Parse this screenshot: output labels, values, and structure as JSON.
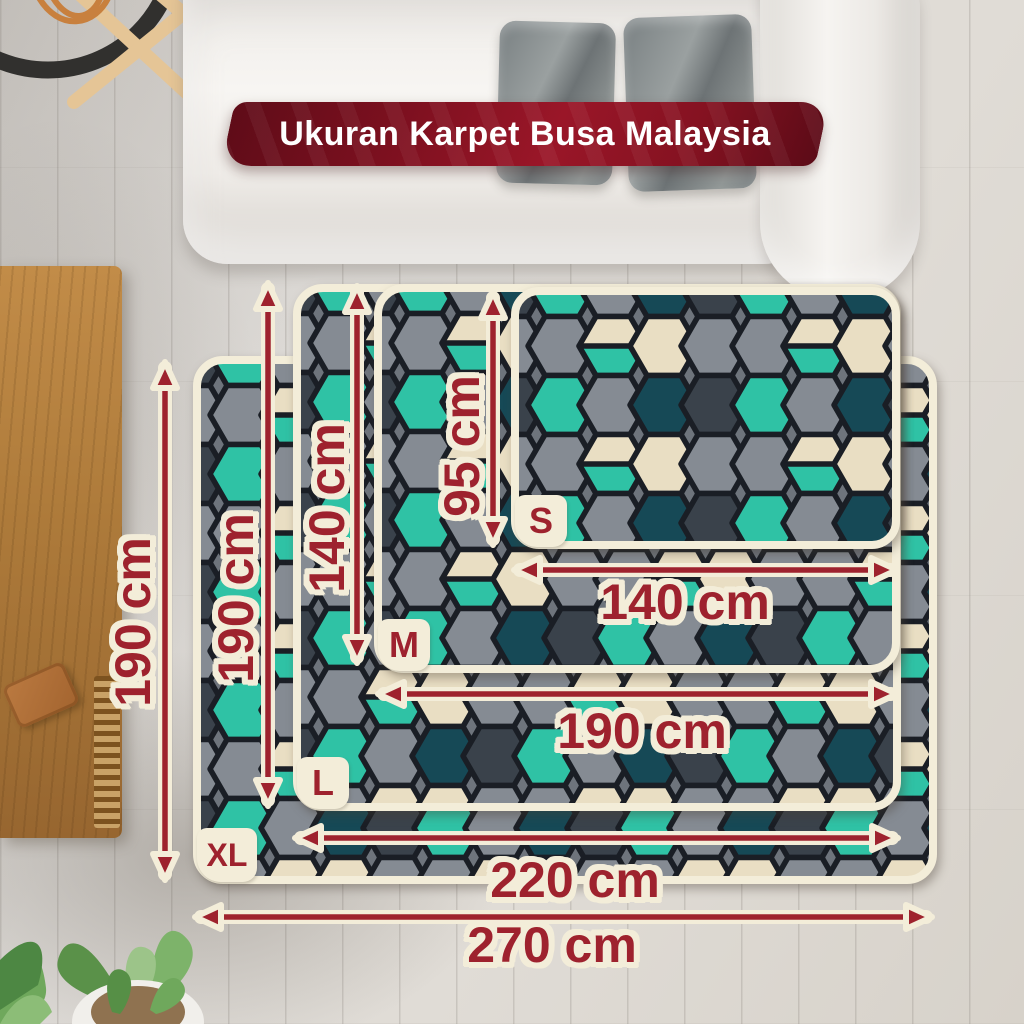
{
  "banner": {
    "title": "Ukuran Karpet Busa Malaysia"
  },
  "sizes": [
    {
      "code": "S",
      "width_cm": 140,
      "height_cm": 95,
      "width_label": "140 cm",
      "height_label": "95 cm"
    },
    {
      "code": "M",
      "width_cm": 190,
      "height_cm": 140,
      "width_label": "190 cm",
      "height_label": "140 cm"
    },
    {
      "code": "L",
      "width_cm": 220,
      "height_cm": 190,
      "width_label": "220 cm",
      "height_label": "190 cm"
    },
    {
      "code": "XL",
      "width_cm": 270,
      "height_cm": 190,
      "width_label": "270 cm",
      "height_label": "190 cm"
    }
  ],
  "colors": {
    "accent_red": "#9e222e",
    "outline_cream": "#f3edd9",
    "banner_red": "#8c1222",
    "carpet_gray": "#858b93",
    "carpet_light_gray": "#9ba1a9",
    "carpet_slate": "#3a424b",
    "carpet_dark_teal": "#164956",
    "carpet_teal": "#2fc2a5",
    "carpet_cream": "#e9dec3"
  }
}
